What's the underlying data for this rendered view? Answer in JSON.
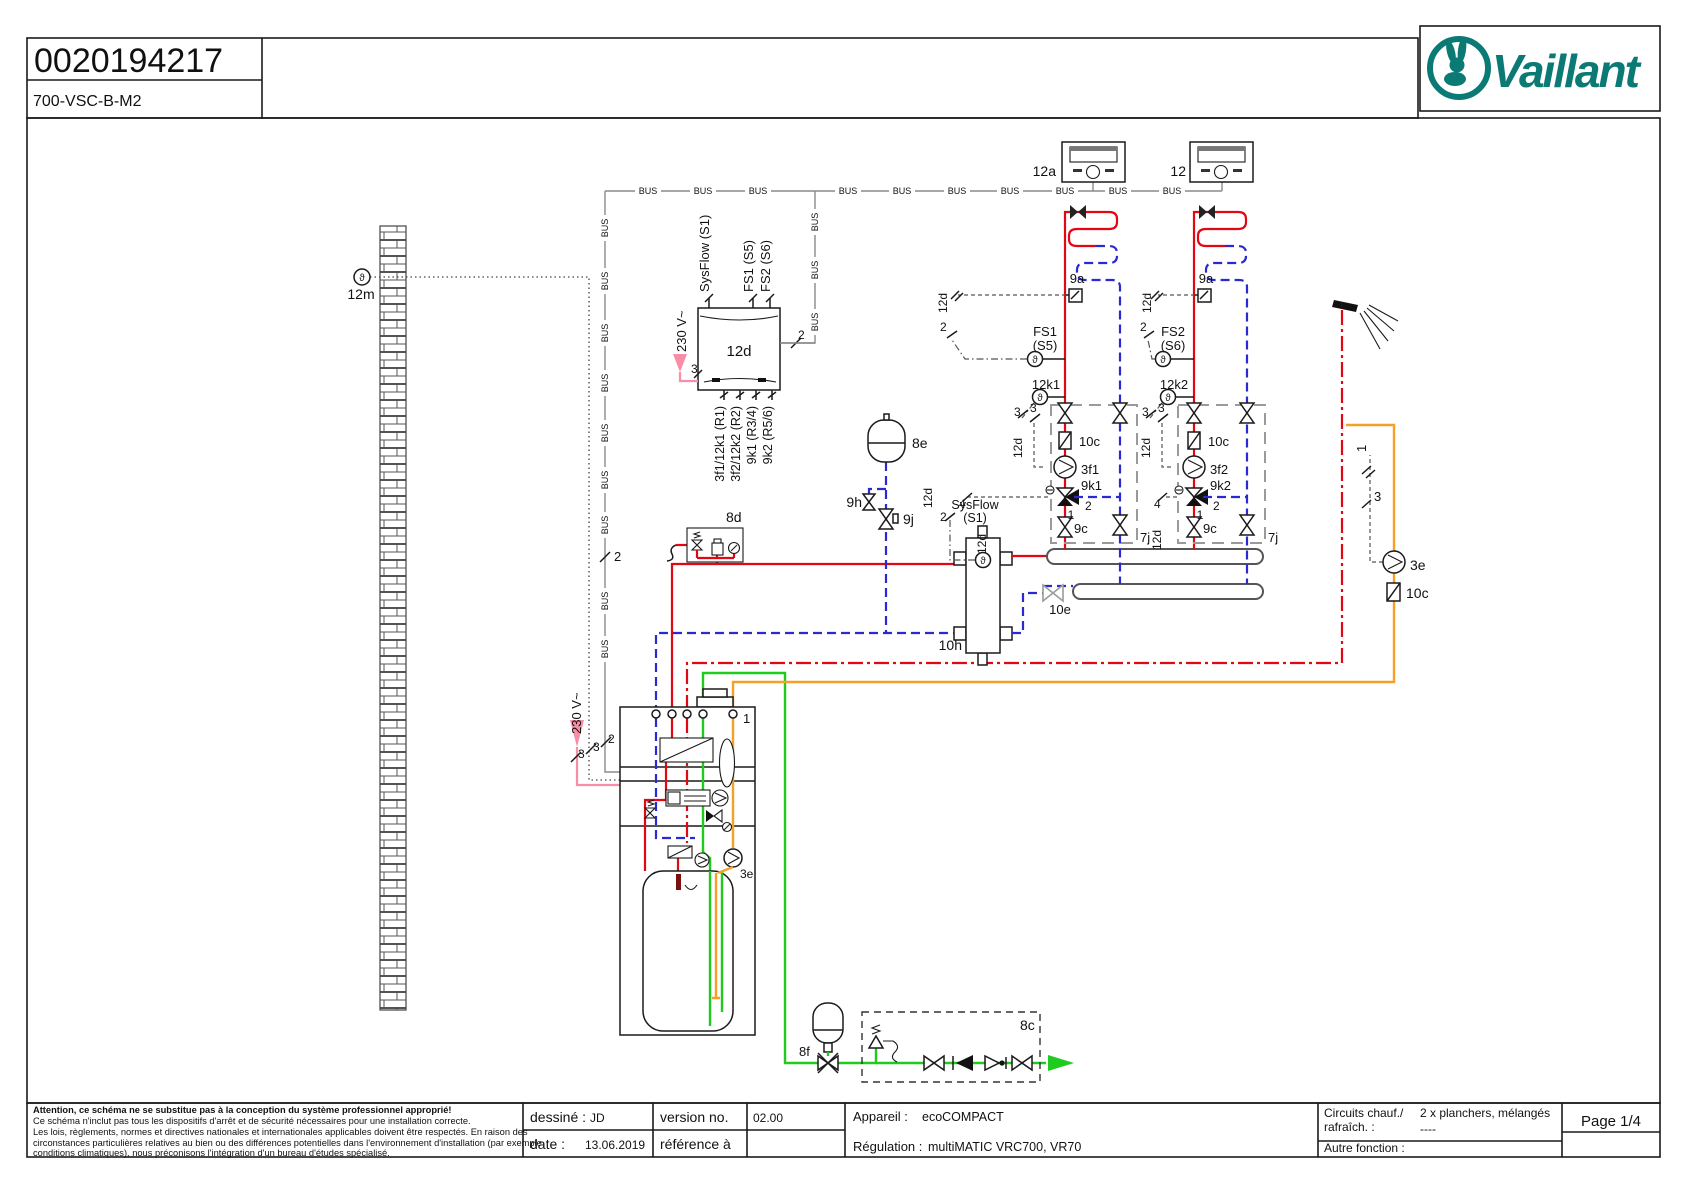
{
  "header": {
    "doc_number": "0020194217",
    "doc_code": "700-VSC-B-M2",
    "brand": "Vaillant"
  },
  "footer": {
    "attention_lines": [
      "Attention, ce schéma ne se substitue pas à la conception du système professionnel approprié!",
      "Ce schéma n'inclut pas tous les dispositifs d'arrêt et de sécurité nécessaires pour une installation correcte.",
      "Les lois, règlements, normes et directives nationales et internationales applicables doivent être respectés. En raison des",
      "circonstances particulières relatives au bien ou des différences potentielles dans l'environnement d'installation (par exemple",
      "conditions climatiques), nous préconisons l'intégration d'un bureau d'études spécialisé."
    ],
    "drawn_label": "dessiné :",
    "drawn_value": "JD",
    "version_label": "version no.",
    "version_value": "02.00",
    "date_label": "date :",
    "date_value": "13.06.2019",
    "reference_label": "référence à",
    "device_label": "Appareil :",
    "device_value": "ecoCOMPACT",
    "regulation_label": "Régulation :",
    "regulation_value": "multiMATIC VRC700, VR70",
    "circuits_label_1": "Circuits chauf./",
    "circuits_label_2": "rafraîch. :",
    "circuits_value_1": "2 x planchers, mélangés",
    "circuits_value_2": "----",
    "other_label": "Autre fonction :",
    "page": "Page 1/4"
  },
  "diagram": {
    "bus_text": "BUS",
    "sensor_glyph": "ϑ",
    "bus_labels": [
      {
        "x": 648,
        "y": 191
      },
      {
        "x": 703,
        "y": 191
      },
      {
        "x": 758,
        "y": 191
      },
      {
        "x": 848,
        "y": 191
      },
      {
        "x": 902,
        "y": 191
      },
      {
        "x": 957,
        "y": 191
      },
      {
        "x": 1010,
        "y": 191
      },
      {
        "x": 1065,
        "y": 191
      },
      {
        "x": 1118,
        "y": 191
      },
      {
        "x": 1172,
        "y": 191
      },
      {
        "x": 605,
        "y": 228,
        "r": -90
      },
      {
        "x": 605,
        "y": 281,
        "r": -90
      },
      {
        "x": 605,
        "y": 333,
        "r": -90
      },
      {
        "x": 605,
        "y": 383,
        "r": -90
      },
      {
        "x": 605,
        "y": 433,
        "r": -90
      },
      {
        "x": 605,
        "y": 480,
        "r": -90
      },
      {
        "x": 605,
        "y": 525,
        "r": -90
      },
      {
        "x": 605,
        "y": 601,
        "r": -90
      },
      {
        "x": 605,
        "y": 649,
        "r": -90
      },
      {
        "x": 815,
        "y": 222,
        "r": -90
      },
      {
        "x": 815,
        "y": 270,
        "r": -90
      },
      {
        "x": 815,
        "y": 322,
        "r": -90
      }
    ],
    "labels": [
      {
        "t": "12m",
        "x": 361,
        "y": 299,
        "a": "middle",
        "s": 14,
        "n": "label-outdoor-sensor-12m"
      },
      {
        "t": "12a",
        "x": 1056,
        "y": 176,
        "a": "end",
        "s": 14,
        "n": "label-room-control-12a"
      },
      {
        "t": "12",
        "x": 1186,
        "y": 176,
        "a": "end",
        "s": 14,
        "n": "label-room-control-12"
      },
      {
        "t": "2",
        "x": 614,
        "y": 561,
        "s": 13
      },
      {
        "t": "SysFlow (S1)",
        "x": 709,
        "y": 292,
        "r": -90,
        "s": 13,
        "n": "label-terminal-sysflow"
      },
      {
        "t": "FS1 (S5)",
        "x": 753,
        "y": 292,
        "r": -90,
        "s": 13,
        "n": "label-terminal-fs1"
      },
      {
        "t": "FS2 (S6)",
        "x": 770,
        "y": 292,
        "r": -90,
        "s": 13,
        "n": "label-terminal-fs2"
      },
      {
        "t": "230 V~",
        "x": 686,
        "y": 352,
        "r": -90,
        "s": 13,
        "n": "label-230v-vr70"
      },
      {
        "t": "3",
        "x": 691,
        "y": 373,
        "s": 12
      },
      {
        "t": "12d",
        "x": 739,
        "y": 356,
        "a": "middle",
        "s": 15,
        "n": "label-vr70-12d"
      },
      {
        "t": "2",
        "x": 798,
        "y": 339,
        "s": 12
      },
      {
        "t": "3f1/12k1 (R1)",
        "x": 724,
        "y": 406,
        "r": -90,
        "a": "end",
        "s": 12.5,
        "n": "label-terminal-r1"
      },
      {
        "t": "3f2/12k2 (R2)",
        "x": 740,
        "y": 406,
        "r": -90,
        "a": "end",
        "s": 12.5,
        "n": "label-terminal-r2"
      },
      {
        "t": "9k1 (R3/4)",
        "x": 756,
        "y": 406,
        "r": -90,
        "a": "end",
        "s": 12.5,
        "n": "label-terminal-r34"
      },
      {
        "t": "9k2 (R5/6)",
        "x": 772,
        "y": 406,
        "r": -90,
        "a": "end",
        "s": 12.5,
        "n": "label-terminal-r56"
      },
      {
        "t": "8e",
        "x": 912,
        "y": 448,
        "s": 14,
        "n": "label-expansion-8e"
      },
      {
        "t": "9h",
        "x": 862,
        "y": 507,
        "a": "end",
        "s": 14,
        "n": "label-valve-9h"
      },
      {
        "t": "9j",
        "x": 903,
        "y": 524,
        "s": 14,
        "n": "label-valve-9j"
      },
      {
        "t": "8d",
        "x": 726,
        "y": 522,
        "s": 14,
        "n": "label-safety-group-8d"
      },
      {
        "t": "SysFlow",
        "x": 975,
        "y": 509,
        "a": "middle",
        "s": 12.5,
        "n": "label-sysflow-sensor"
      },
      {
        "t": "(S1)",
        "x": 975,
        "y": 522,
        "a": "middle",
        "s": 12.5
      },
      {
        "t": "12d",
        "x": 932,
        "y": 508,
        "r": -90,
        "s": 12
      },
      {
        "t": "2",
        "x": 940,
        "y": 521,
        "s": 12
      },
      {
        "t": "10h",
        "x": 962,
        "y": 650,
        "a": "end",
        "s": 14,
        "n": "label-separator-10h"
      },
      {
        "t": "10e",
        "x": 1060,
        "y": 614,
        "a": "middle",
        "s": 13,
        "c": "#9a9a9a",
        "n": "label-valve-10e"
      },
      {
        "t": "9a",
        "x": 1077,
        "y": 283,
        "a": "middle",
        "s": 13,
        "n": "label-zone-valve-9a-1"
      },
      {
        "t": "9a",
        "x": 1206,
        "y": 283,
        "a": "middle",
        "s": 13,
        "n": "label-zone-valve-9a-2"
      },
      {
        "t": "12d",
        "x": 947,
        "y": 313,
        "r": -90,
        "s": 12
      },
      {
        "t": "12d",
        "x": 1151,
        "y": 313,
        "r": -90,
        "s": 12
      },
      {
        "t": "2",
        "x": 940,
        "y": 331,
        "s": 12
      },
      {
        "t": "2",
        "x": 1140,
        "y": 331,
        "s": 12
      },
      {
        "t": "FS1",
        "x": 1045,
        "y": 336,
        "a": "middle",
        "s": 13,
        "n": "label-flow-sensor-fs1"
      },
      {
        "t": "(S5)",
        "x": 1045,
        "y": 350,
        "a": "middle",
        "s": 13
      },
      {
        "t": "FS2",
        "x": 1173,
        "y": 336,
        "a": "middle",
        "s": 13,
        "n": "label-flow-sensor-fs2"
      },
      {
        "t": "(S6)",
        "x": 1173,
        "y": 350,
        "a": "middle",
        "s": 13
      },
      {
        "t": "12k1",
        "x": 1046,
        "y": 389,
        "a": "middle",
        "s": 13,
        "n": "label-sensor-12k1"
      },
      {
        "t": "12k2",
        "x": 1174,
        "y": 389,
        "a": "middle",
        "s": 13,
        "n": "label-sensor-12k2"
      },
      {
        "t": "3",
        "x": 1014,
        "y": 416,
        "s": 12
      },
      {
        "t": "3",
        "x": 1030,
        "y": 412,
        "s": 12
      },
      {
        "t": "3",
        "x": 1142,
        "y": 416,
        "s": 12
      },
      {
        "t": "3",
        "x": 1158,
        "y": 412,
        "s": 12
      },
      {
        "t": "12d",
        "x": 1022,
        "y": 458,
        "r": -90,
        "s": 12
      },
      {
        "t": "12d",
        "x": 1150,
        "y": 458,
        "r": -90,
        "s": 12
      },
      {
        "t": "10c",
        "x": 1079,
        "y": 446,
        "s": 13,
        "n": "label-check-10c-1"
      },
      {
        "t": "10c",
        "x": 1208,
        "y": 446,
        "s": 13,
        "n": "label-check-10c-2"
      },
      {
        "t": "3f1",
        "x": 1081,
        "y": 474,
        "s": 13,
        "n": "label-pump-3f1"
      },
      {
        "t": "3f2",
        "x": 1210,
        "y": 474,
        "s": 13,
        "n": "label-pump-3f2"
      },
      {
        "t": "9k1",
        "x": 1081,
        "y": 490,
        "s": 13,
        "n": "label-mixer-9k1"
      },
      {
        "t": "9k2",
        "x": 1210,
        "y": 490,
        "s": 13,
        "n": "label-mixer-9k2"
      },
      {
        "t": "4",
        "x": 959,
        "y": 508,
        "s": 12
      },
      {
        "t": "4",
        "x": 1154,
        "y": 508,
        "s": 12
      },
      {
        "t": "1",
        "x": 1071,
        "y": 519,
        "a": "middle",
        "s": 12
      },
      {
        "t": "2",
        "x": 1085,
        "y": 510,
        "s": 12
      },
      {
        "t": "1",
        "x": 1200,
        "y": 519,
        "a": "middle",
        "s": 12
      },
      {
        "t": "2",
        "x": 1213,
        "y": 510,
        "s": 12
      },
      {
        "t": "12d",
        "x": 986,
        "y": 554,
        "r": -90,
        "s": 12
      },
      {
        "t": "12d",
        "x": 1161,
        "y": 550,
        "r": -90,
        "s": 12
      },
      {
        "t": "9c",
        "x": 1074,
        "y": 533,
        "s": 13,
        "n": "label-valve-9c-1"
      },
      {
        "t": "9c",
        "x": 1203,
        "y": 533,
        "s": 13,
        "n": "label-valve-9c-2"
      },
      {
        "t": "7j",
        "x": 1140,
        "y": 542,
        "s": 13,
        "n": "label-7j-1"
      },
      {
        "t": "7j",
        "x": 1268,
        "y": 542,
        "s": 13,
        "n": "label-7j-2"
      },
      {
        "t": "1",
        "x": 1366,
        "y": 452,
        "r": -90,
        "s": 13
      },
      {
        "t": "3",
        "x": 1374,
        "y": 501,
        "s": 13
      },
      {
        "t": "3e",
        "x": 1410,
        "y": 570,
        "s": 14,
        "n": "label-circulation-pump-3e"
      },
      {
        "t": "10c",
        "x": 1406,
        "y": 598,
        "s": 14,
        "n": "label-check-10c-circ"
      },
      {
        "t": "3e",
        "x": 740,
        "y": 878,
        "s": 12,
        "n": "label-pump-3e-internal"
      },
      {
        "t": "1",
        "x": 743,
        "y": 723,
        "s": 13,
        "n": "label-boiler-1"
      },
      {
        "t": "230 V~",
        "x": 581,
        "y": 734,
        "r": -90,
        "s": 13,
        "n": "label-230v-boiler"
      },
      {
        "t": "3",
        "x": 578,
        "y": 758,
        "s": 12
      },
      {
        "t": "3",
        "x": 593,
        "y": 751,
        "s": 12
      },
      {
        "t": "2",
        "x": 608,
        "y": 743,
        "s": 12
      },
      {
        "t": "8f",
        "x": 799,
        "y": 1056,
        "s": 13,
        "n": "label-expansion-8f"
      },
      {
        "t": "8c",
        "x": 1020,
        "y": 1030,
        "s": 14,
        "n": "label-safety-group-8c"
      }
    ]
  }
}
